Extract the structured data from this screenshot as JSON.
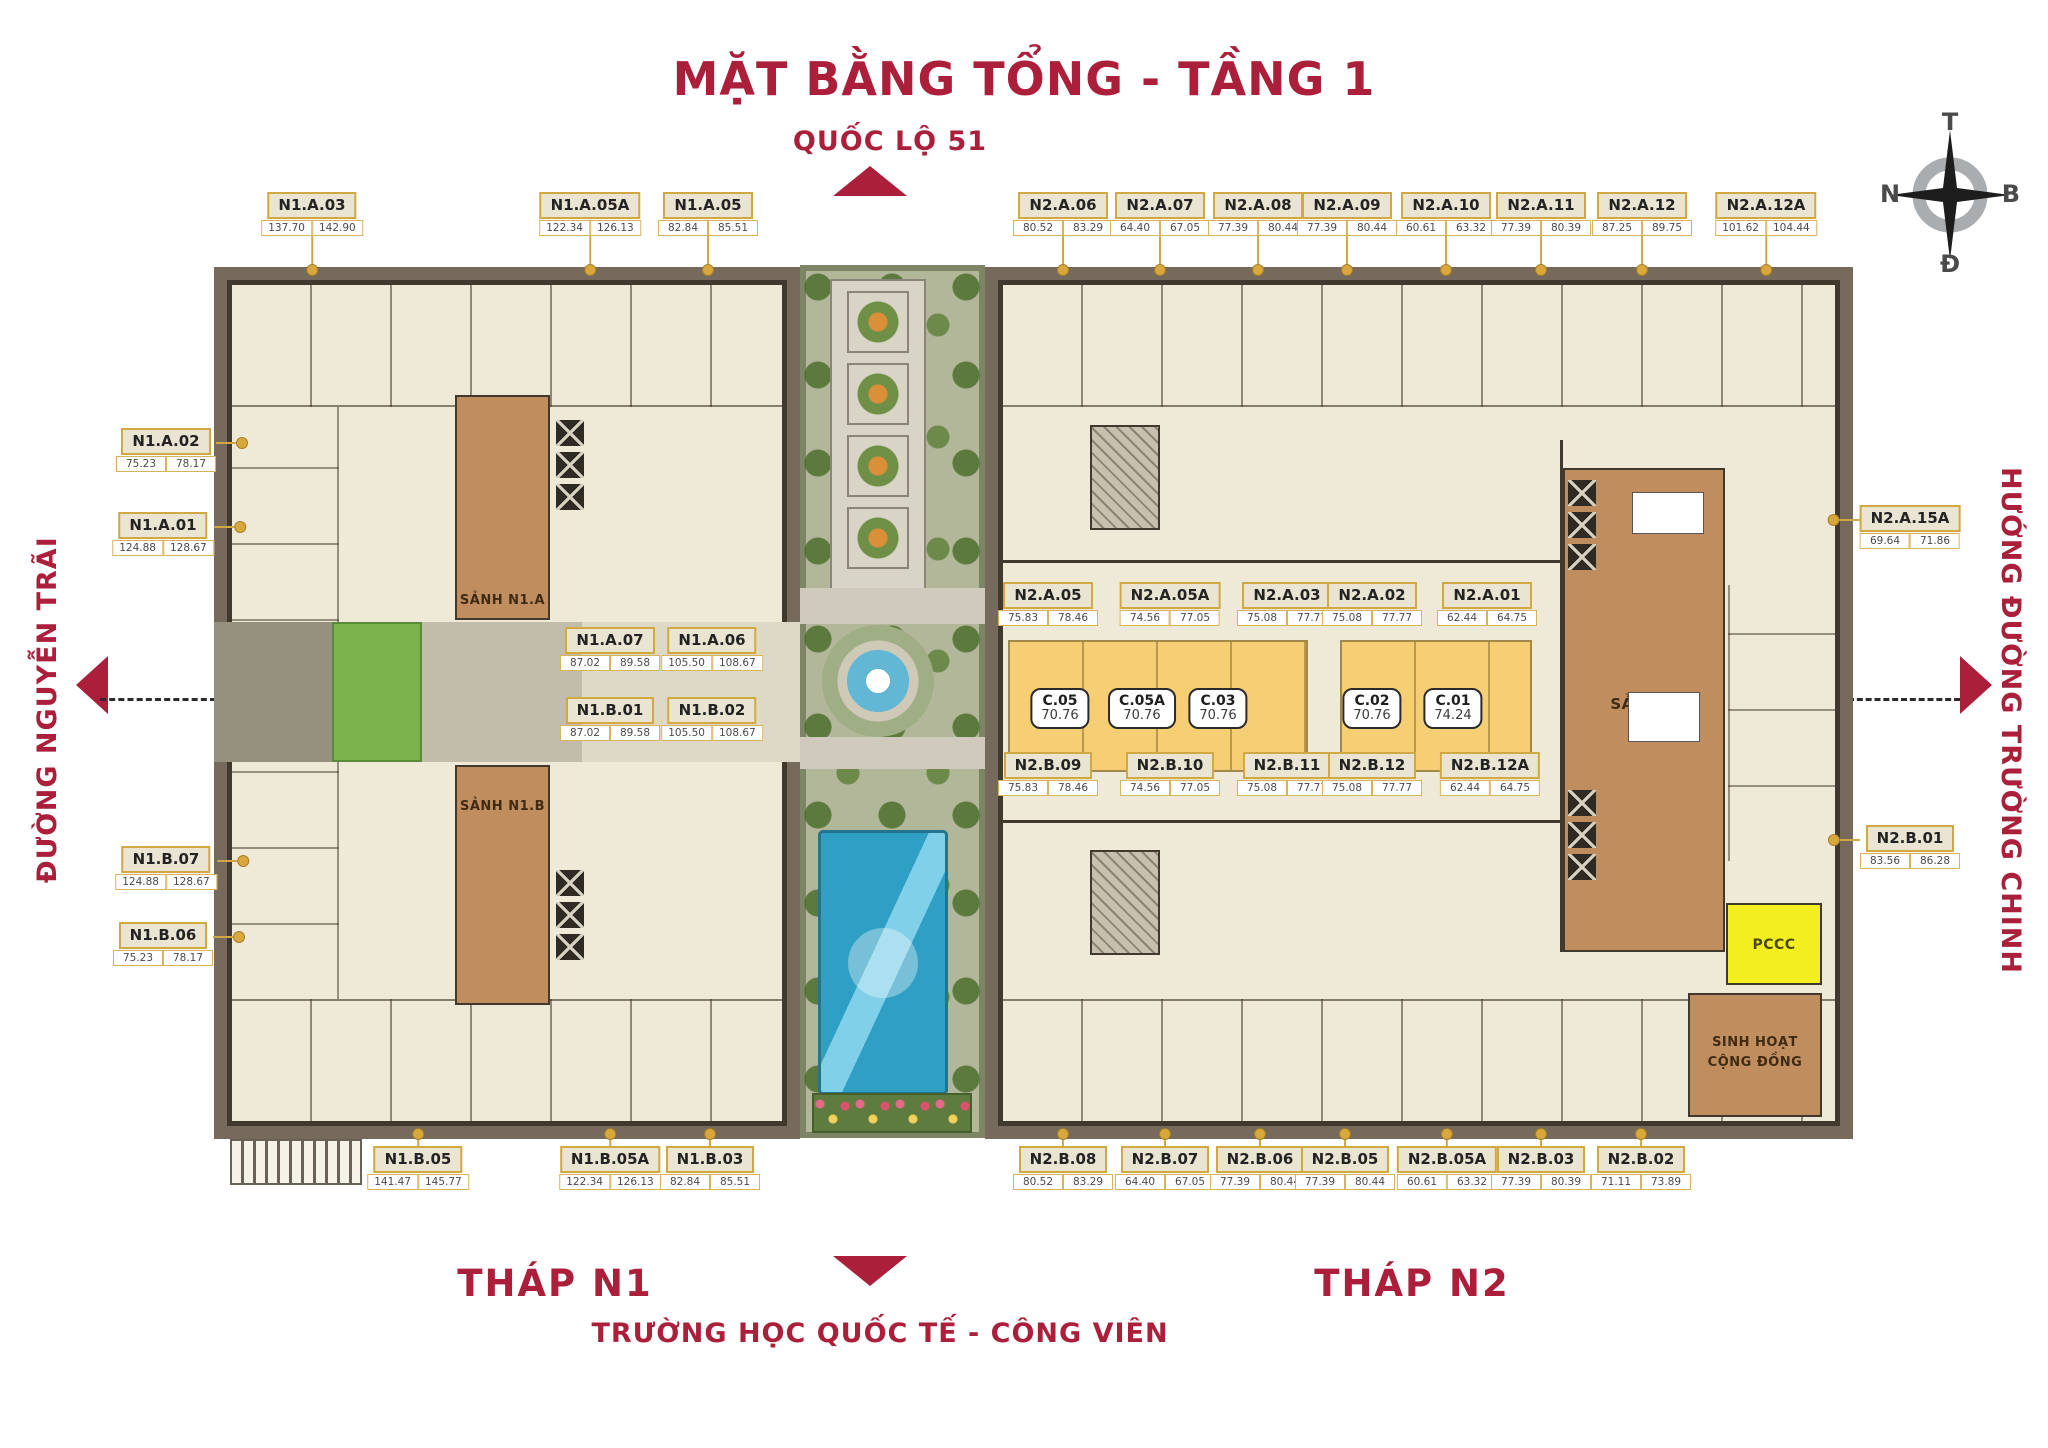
{
  "title": "MẶT BẰNG TỔNG - TẦNG 1",
  "roads": {
    "top": "QUỐC LỘ 51",
    "left": "ĐƯỜNG NGUYỄN TRÃI",
    "right": "HƯỚNG ĐƯỜNG TRƯỜNG CHINH",
    "bottom": "TRƯỜNG HỌC QUỐC TẾ - CÔNG VIÊN"
  },
  "towers": {
    "n1": "THÁP N1",
    "n2": "THÁP N2"
  },
  "compass": {
    "top": "T",
    "right": "B",
    "bottom": "Đ",
    "left": "N"
  },
  "rooms": {
    "lobby_n1a": "SẢNH N1.A",
    "lobby_n1b": "SẢNH N1.B",
    "lobby_n2": "SẢNH V",
    "pccc": "PCCC",
    "community_line1": "SINH HOẠT",
    "community_line2": "CỘNG ĐỒNG"
  },
  "colors": {
    "accent_red": "#ab1f3a",
    "badge_gold": "#d2a843",
    "floor_cream": "#efe9d8",
    "wall_dark": "#42392e",
    "outer_band": "#756a5c",
    "shop_yellow": "#f6ce74",
    "lobby_brown": "#c08d5f",
    "pccc_yellow": "#f2ee1f",
    "lawn_green": "#7cb24c",
    "pool_blue": "#2f9fc4"
  },
  "units": [
    {
      "id": "N1.A.03",
      "a1": "137.70",
      "a2": "142.90",
      "x": 312,
      "y": 192,
      "dir": "down",
      "len": 34
    },
    {
      "id": "N1.A.05A",
      "a1": "122.34",
      "a2": "126.13",
      "x": 590,
      "y": 192,
      "dir": "down",
      "len": 34
    },
    {
      "id": "N1.A.05",
      "a1": "82.84",
      "a2": "85.51",
      "x": 708,
      "y": 192,
      "dir": "down",
      "len": 34
    },
    {
      "id": "N2.A.06",
      "a1": "80.52",
      "a2": "83.29",
      "x": 1063,
      "y": 192,
      "dir": "down",
      "len": 34
    },
    {
      "id": "N2.A.07",
      "a1": "64.40",
      "a2": "67.05",
      "x": 1160,
      "y": 192,
      "dir": "down",
      "len": 34
    },
    {
      "id": "N2.A.08",
      "a1": "77.39",
      "a2": "80.44",
      "x": 1258,
      "y": 192,
      "dir": "down",
      "len": 34
    },
    {
      "id": "N2.A.09",
      "a1": "77.39",
      "a2": "80.44",
      "x": 1347,
      "y": 192,
      "dir": "down",
      "len": 34
    },
    {
      "id": "N2.A.10",
      "a1": "60.61",
      "a2": "63.32",
      "x": 1446,
      "y": 192,
      "dir": "down",
      "len": 34
    },
    {
      "id": "N2.A.11",
      "a1": "77.39",
      "a2": "80.39",
      "x": 1541,
      "y": 192,
      "dir": "down",
      "len": 34
    },
    {
      "id": "N2.A.12",
      "a1": "87.25",
      "a2": "89.75",
      "x": 1642,
      "y": 192,
      "dir": "down",
      "len": 34
    },
    {
      "id": "N2.A.12A",
      "a1": "101.62",
      "a2": "104.44",
      "x": 1766,
      "y": 192,
      "dir": "down",
      "len": 34
    },
    {
      "id": "N1.A.02",
      "a1": "75.23",
      "a2": "78.17",
      "x": 166,
      "y": 428,
      "dir": "right",
      "len": 26
    },
    {
      "id": "N1.A.01",
      "a1": "124.88",
      "a2": "128.67",
      "x": 163,
      "y": 512,
      "dir": "right",
      "len": 26
    },
    {
      "id": "N1.B.07",
      "a1": "124.88",
      "a2": "128.67",
      "x": 166,
      "y": 846,
      "dir": "right",
      "len": 26
    },
    {
      "id": "N1.B.06",
      "a1": "75.23",
      "a2": "78.17",
      "x": 163,
      "y": 922,
      "dir": "right",
      "len": 26
    },
    {
      "id": "N2.A.15A",
      "a1": "69.64",
      "a2": "71.86",
      "x": 1910,
      "y": 505,
      "dir": "left",
      "len": 26
    },
    {
      "id": "N2.B.01",
      "a1": "83.56",
      "a2": "86.28",
      "x": 1910,
      "y": 825,
      "dir": "left",
      "len": 26
    },
    {
      "id": "N1.A.07",
      "a1": "87.02",
      "a2": "89.58",
      "x": 610,
      "y": 627,
      "dir": "none",
      "len": 0
    },
    {
      "id": "N1.A.06",
      "a1": "105.50",
      "a2": "108.67",
      "x": 712,
      "y": 627,
      "dir": "none",
      "len": 0
    },
    {
      "id": "N1.B.01",
      "a1": "87.02",
      "a2": "89.58",
      "x": 610,
      "y": 697,
      "dir": "none",
      "len": 0
    },
    {
      "id": "N1.B.02",
      "a1": "105.50",
      "a2": "108.67",
      "x": 712,
      "y": 697,
      "dir": "none",
      "len": 0
    },
    {
      "id": "N2.A.05",
      "a1": "75.83",
      "a2": "78.46",
      "x": 1048,
      "y": 582,
      "dir": "none",
      "len": 0
    },
    {
      "id": "N2.A.05A",
      "a1": "74.56",
      "a2": "77.05",
      "x": 1170,
      "y": 582,
      "dir": "none",
      "len": 0
    },
    {
      "id": "N2.A.03",
      "a1": "75.08",
      "a2": "77.77",
      "x": 1287,
      "y": 582,
      "dir": "none",
      "len": 0
    },
    {
      "id": "N2.A.02",
      "a1": "75.08",
      "a2": "77.77",
      "x": 1372,
      "y": 582,
      "dir": "none",
      "len": 0
    },
    {
      "id": "N2.A.01",
      "a1": "62.44",
      "a2": "64.75",
      "x": 1487,
      "y": 582,
      "dir": "none",
      "len": 0
    },
    {
      "id": "N2.B.09",
      "a1": "75.83",
      "a2": "78.46",
      "x": 1048,
      "y": 752,
      "dir": "none",
      "len": 0
    },
    {
      "id": "N2.B.10",
      "a1": "74.56",
      "a2": "77.05",
      "x": 1170,
      "y": 752,
      "dir": "none",
      "len": 0
    },
    {
      "id": "N2.B.11",
      "a1": "75.08",
      "a2": "77.77",
      "x": 1287,
      "y": 752,
      "dir": "none",
      "len": 0
    },
    {
      "id": "N2.B.12",
      "a1": "75.08",
      "a2": "77.77",
      "x": 1372,
      "y": 752,
      "dir": "none",
      "len": 0
    },
    {
      "id": "N2.B.12A",
      "a1": "62.44",
      "a2": "64.75",
      "x": 1490,
      "y": 752,
      "dir": "none",
      "len": 0
    },
    {
      "id": "N1.B.05",
      "a1": "141.47",
      "a2": "145.77",
      "x": 418,
      "y": 1146,
      "dir": "up",
      "len": 12
    },
    {
      "id": "N1.B.05A",
      "a1": "122.34",
      "a2": "126.13",
      "x": 610,
      "y": 1146,
      "dir": "up",
      "len": 12
    },
    {
      "id": "N1.B.03",
      "a1": "82.84",
      "a2": "85.51",
      "x": 710,
      "y": 1146,
      "dir": "up",
      "len": 12
    },
    {
      "id": "N2.B.08",
      "a1": "80.52",
      "a2": "83.29",
      "x": 1063,
      "y": 1146,
      "dir": "up",
      "len": 12
    },
    {
      "id": "N2.B.07",
      "a1": "64.40",
      "a2": "67.05",
      "x": 1165,
      "y": 1146,
      "dir": "up",
      "len": 12
    },
    {
      "id": "N2.B.06",
      "a1": "77.39",
      "a2": "80.44",
      "x": 1260,
      "y": 1146,
      "dir": "up",
      "len": 12
    },
    {
      "id": "N2.B.05",
      "a1": "77.39",
      "a2": "80.44",
      "x": 1345,
      "y": 1146,
      "dir": "up",
      "len": 12
    },
    {
      "id": "N2.B.05A",
      "a1": "60.61",
      "a2": "63.32",
      "x": 1447,
      "y": 1146,
      "dir": "up",
      "len": 12
    },
    {
      "id": "N2.B.03",
      "a1": "77.39",
      "a2": "80.39",
      "x": 1541,
      "y": 1146,
      "dir": "up",
      "len": 12
    },
    {
      "id": "N2.B.02",
      "a1": "71.11",
      "a2": "73.89",
      "x": 1641,
      "y": 1146,
      "dir": "up",
      "len": 12
    }
  ],
  "c_units": [
    {
      "id": "C.05",
      "area": "70.76",
      "x": 1060,
      "y": 688
    },
    {
      "id": "C.05A",
      "area": "70.76",
      "x": 1142,
      "y": 688
    },
    {
      "id": "C.03",
      "area": "70.76",
      "x": 1218,
      "y": 688
    },
    {
      "id": "C.02",
      "area": "70.76",
      "x": 1372,
      "y": 688
    },
    {
      "id": "C.01",
      "area": "74.24",
      "x": 1453,
      "y": 688
    }
  ]
}
